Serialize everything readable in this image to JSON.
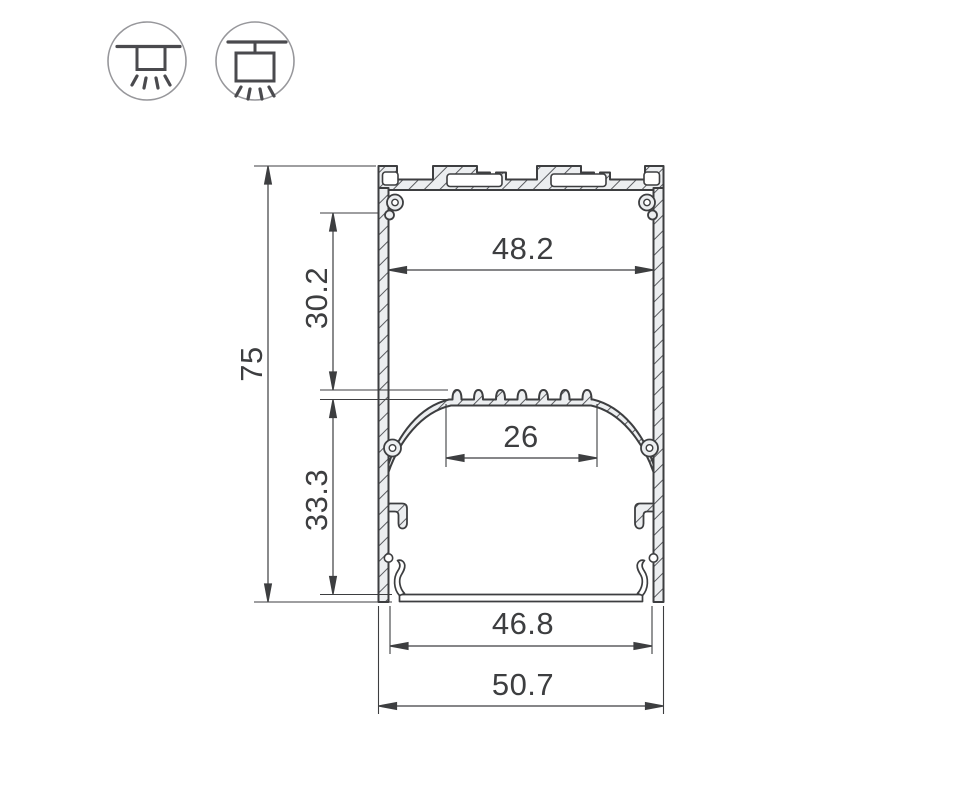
{
  "drawing": {
    "type": "aluminum-led-profile-cross-section",
    "dimensions": {
      "overall_height": "75",
      "upper_section_height": "30.2",
      "lower_section_height": "33.3",
      "inner_width_top": "48.2",
      "led_platform_width": "26",
      "inner_width_bottom": "46.8",
      "overall_width": "50.7"
    },
    "icons": [
      {
        "name": "surface-mount-icon"
      },
      {
        "name": "pendant-mount-icon"
      }
    ],
    "colors": {
      "line": "#3d3e40",
      "material_fill": "#eceef0",
      "icon_circle": "#97979b",
      "background": "#ffffff"
    }
  }
}
